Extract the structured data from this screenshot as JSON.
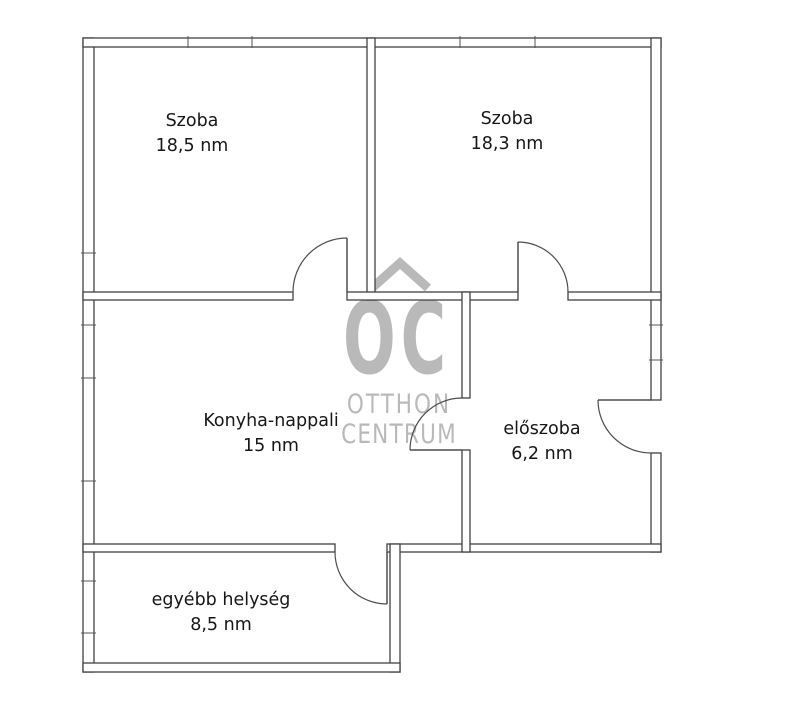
{
  "plan": {
    "background": "#ffffff",
    "wall_color": "#424242",
    "door_color": "#4d4d4d"
  },
  "watermark": {
    "roof_icon": "roof-chevron-icon",
    "logo_text": "OC",
    "brand_line1": "OTTHON",
    "brand_line2": "CENTRUM",
    "color": "#b9b9b9"
  },
  "rooms": [
    {
      "name": "Szoba",
      "area": "18,5 nm"
    },
    {
      "name": "Szoba",
      "area": "18,3 nm"
    },
    {
      "name": "Konyha-nappali",
      "area": "15 nm"
    },
    {
      "name": "előszoba",
      "area": "6,2 nm"
    },
    {
      "name": "egyébb helység",
      "area": "8,5 nm"
    }
  ]
}
